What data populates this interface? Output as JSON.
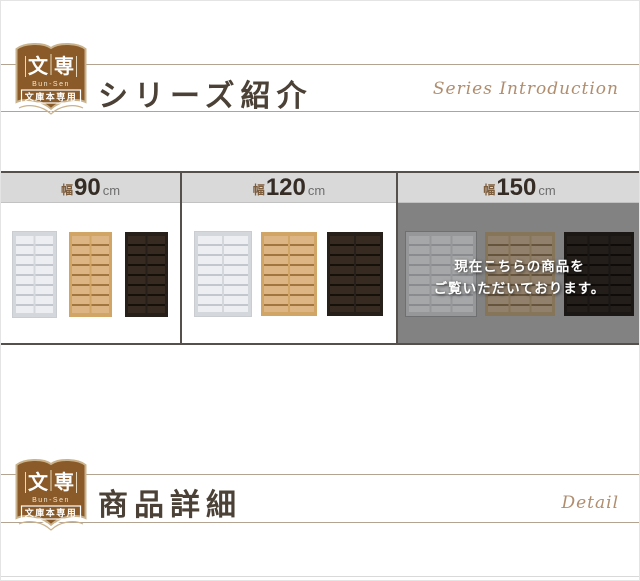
{
  "brand": {
    "logo": {
      "kanji_left": "文",
      "kanji_right": "専",
      "romaji": "Bun-Sen",
      "tagline": "文庫本専用"
    }
  },
  "headers": {
    "series": {
      "title": "シリーズ紹介",
      "script": "Series Introduction"
    },
    "detail": {
      "title": "商品詳細",
      "script": "Detail"
    }
  },
  "products": {
    "tabs": [
      {
        "prefix": "幅",
        "size": "90",
        "unit": "cm",
        "current": false
      },
      {
        "prefix": "幅",
        "size": "120",
        "unit": "cm",
        "current": false
      },
      {
        "prefix": "幅",
        "size": "150",
        "unit": "cm",
        "current": true
      }
    ],
    "overlay": {
      "line1": "現在こちらの商品を",
      "line2": "ご覧いただいております。"
    },
    "shelf_sections": [
      {
        "width_cm": "90",
        "columns": 2,
        "rows": 8,
        "shelf_w": 43,
        "shelf_h": 85,
        "gap": 13,
        "dimmed": false
      },
      {
        "width_cm": "120",
        "columns": 2,
        "rows": 8,
        "shelf_w": 56,
        "shelf_h": 84,
        "gap": 10,
        "dimmed": false
      },
      {
        "width_cm": "150",
        "columns": 3,
        "rows": 8,
        "shelf_w": 70,
        "shelf_h": 84,
        "gap": 9,
        "dimmed": true
      }
    ],
    "variants": [
      {
        "name": "white",
        "frame": "#d4d8dd",
        "interior": "#eceef1",
        "line": "#c2c7ce"
      },
      {
        "name": "natural",
        "frame": "#d0a566",
        "interior": "#ddb584",
        "line": "#a1763f"
      },
      {
        "name": "dark-brown",
        "frame": "#27201a",
        "interior": "#362a21",
        "line": "#16100b"
      }
    ]
  },
  "colors": {
    "accent_brown": "#8a5a28",
    "logo_outline": "#c9b28c",
    "band_border": "#55504c",
    "tab_bg": "#d9d9d9",
    "overlay_bg": "#828282",
    "header_rule": "#b3a492"
  }
}
